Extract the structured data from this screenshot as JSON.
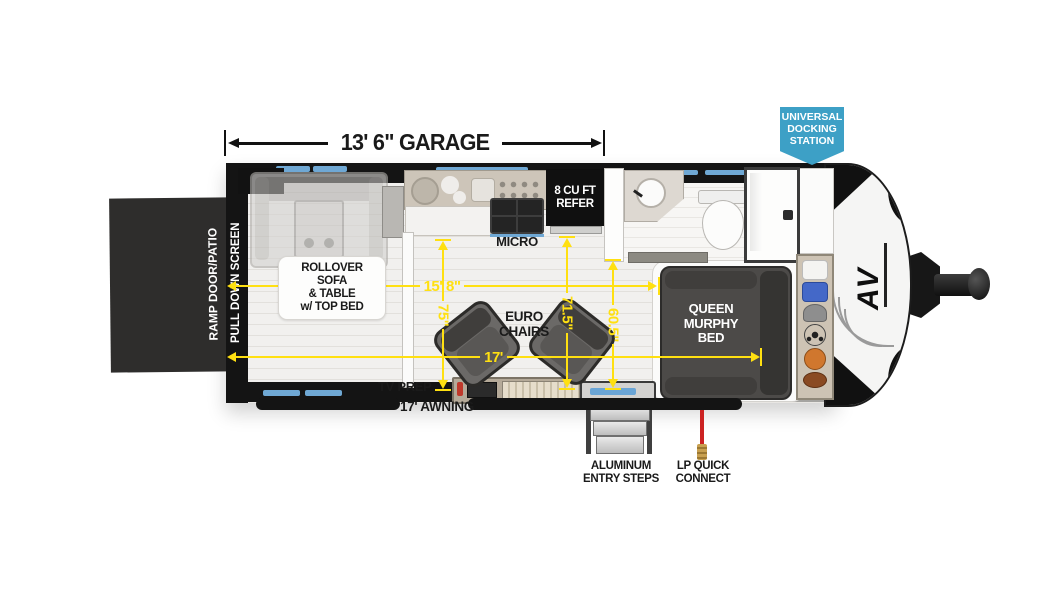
{
  "colors": {
    "dim_yellow": "#ffe011",
    "badge_blue": "#3da0c6",
    "ramp_door": "#2e2d2c",
    "accent_window_blue": "#6fa8d4"
  },
  "badge": {
    "text": "UNIVERSAL\nDOCKING\nSTATION"
  },
  "garage": {
    "dim_label": "13' 6\" GARAGE"
  },
  "exterior": {
    "ramp_door": "RAMP DOOR/PATIO",
    "screen": "PULL DOWN SCREEN",
    "awning": "17' AWNING",
    "steps": "ALUMINUM\nENTRY STEPS",
    "lp": "LP QUICK\nCONNECT",
    "logo": "AV"
  },
  "interior": {
    "sofa": "ROLLOVER\nSOFA\n& TABLE\nw/ TOP BED",
    "micro": "MICRO",
    "refer": "8 CU FT\nREFER",
    "chairs": "EURO\nCHAIRS",
    "bed": "QUEEN\nMURPHY\nBED",
    "tv": "TV PREP"
  },
  "dims": {
    "interior_length": "15' 8\"",
    "awning_length": "17'",
    "garage_width": "75\"",
    "living_width": "71.5\"",
    "bed_width": "60.5\""
  },
  "storage_items": [
    "jersey-white",
    "jersey-blue",
    "cap",
    "soccer-ball",
    "basketball",
    "football"
  ]
}
